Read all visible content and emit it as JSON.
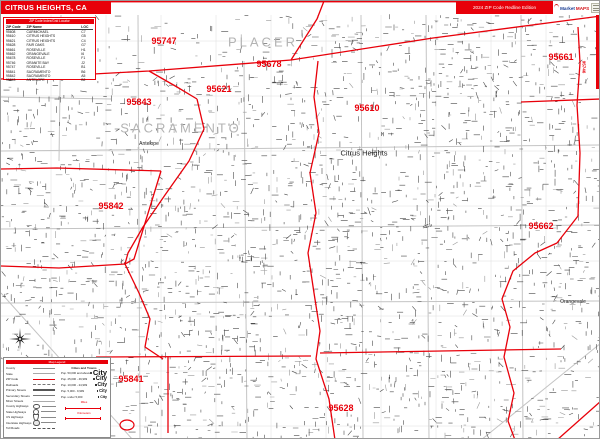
{
  "window": {
    "title": "CITRUS HEIGHTS, CA",
    "edition": "2024 ZIP Code Redline Edition",
    "logo_text_1": "Market",
    "logo_text_2": "MAPS"
  },
  "index_table": {
    "header": "ZIP Code Index/Grid Locator",
    "columns": [
      "ZIP Code",
      "ZIP Name",
      "LOC"
    ],
    "rows": [
      [
        "95608",
        "CARMICHAEL",
        "C7"
      ],
      [
        "95610",
        "CITRUS HEIGHTS",
        "G5"
      ],
      [
        "95621",
        "CITRUS HEIGHTS",
        "C4"
      ],
      [
        "95628",
        "FAIR OAKS",
        "G7"
      ],
      [
        "95661",
        "ROSEVILLE",
        "H1"
      ],
      [
        "95662",
        "ORANGEVALE",
        "I6"
      ],
      [
        "95678",
        "ROSEVILLE",
        "F1"
      ],
      [
        "95746",
        "GRANITE BAY",
        "J2"
      ],
      [
        "95747",
        "ROSEVILLE",
        "B1"
      ],
      [
        "95841",
        "SACRAMENTO",
        "B6"
      ],
      [
        "95842",
        "SACRAMENTO",
        "A5"
      ],
      [
        "95843",
        "ANTELOPE",
        "B2"
      ]
    ]
  },
  "map": {
    "zip_labels": [
      {
        "text": "95747",
        "x": 163,
        "y": 40
      },
      {
        "text": "95678",
        "x": 268,
        "y": 63
      },
      {
        "text": "95621",
        "x": 218,
        "y": 88
      },
      {
        "text": "95843",
        "x": 138,
        "y": 101
      },
      {
        "text": "95610",
        "x": 366,
        "y": 107
      },
      {
        "text": "95661",
        "x": 560,
        "y": 56
      },
      {
        "text": "95842",
        "x": 110,
        "y": 205
      },
      {
        "text": "95662",
        "x": 540,
        "y": 225
      },
      {
        "text": "95841",
        "x": 130,
        "y": 378
      },
      {
        "text": "95628",
        "x": 340,
        "y": 407
      }
    ],
    "county_labels": [
      {
        "text": "PLACER",
        "x": 262,
        "y": 41
      },
      {
        "text": "SACRAMENTO",
        "x": 180,
        "y": 127
      }
    ],
    "city_labels": [
      {
        "text": "Antelope",
        "x": 148,
        "y": 143,
        "size": 5
      },
      {
        "text": "Citrus Heights",
        "x": 363,
        "y": 152,
        "size": 7.5
      },
      {
        "text": "Orangevale",
        "x": 572,
        "y": 301,
        "size": 5
      }
    ],
    "edge_zip_label": {
      "text": "95746",
      "x": 583,
      "y": 66
    }
  },
  "legend": {
    "header": "Map Legend",
    "line_items": [
      {
        "label": "County",
        "sample": "t-county"
      },
      {
        "label": "State",
        "sample": "t-state"
      },
      {
        "label": "ZIP Code",
        "sample": "t-zip"
      },
      {
        "label": "Railroads",
        "sample": "t-rail"
      },
      {
        "label": "Primary Streets",
        "sample": "t-prim"
      },
      {
        "label": "Secondary Streets",
        "sample": "t-sec"
      },
      {
        "label": "Minor Streets",
        "sample": "t-min"
      },
      {
        "label": "County Highways",
        "sample": "i-oval"
      },
      {
        "label": "State Highways",
        "sample": "i-circle"
      },
      {
        "label": "US Highways",
        "sample": "i-shield"
      },
      {
        "label": "Interstate Highways",
        "sample": "i-inter"
      },
      {
        "label": "Toll Roads",
        "sample": "t-toll"
      }
    ],
    "cities_header": "Cities and Towns",
    "city_classes": [
      {
        "label": "Pop. 50,000 and above",
        "sample": "City"
      },
      {
        "label": "Pop. 25,000 - 49,999",
        "sample": "City"
      },
      {
        "label": "Pop. 10,000 - 24,999",
        "sample": "City"
      },
      {
        "label": "Pop. 5,000 - 9,999",
        "sample": "City"
      },
      {
        "label": "Pop. under 5,000",
        "sample": "City"
      }
    ],
    "scale": {
      "miles": "Miles",
      "kilometers": "Kilometers"
    }
  },
  "colors": {
    "zip_boundary_red": "#e8000a",
    "street_gray": "#4c4c4c",
    "county_label_gray": "#b3b3b3"
  }
}
